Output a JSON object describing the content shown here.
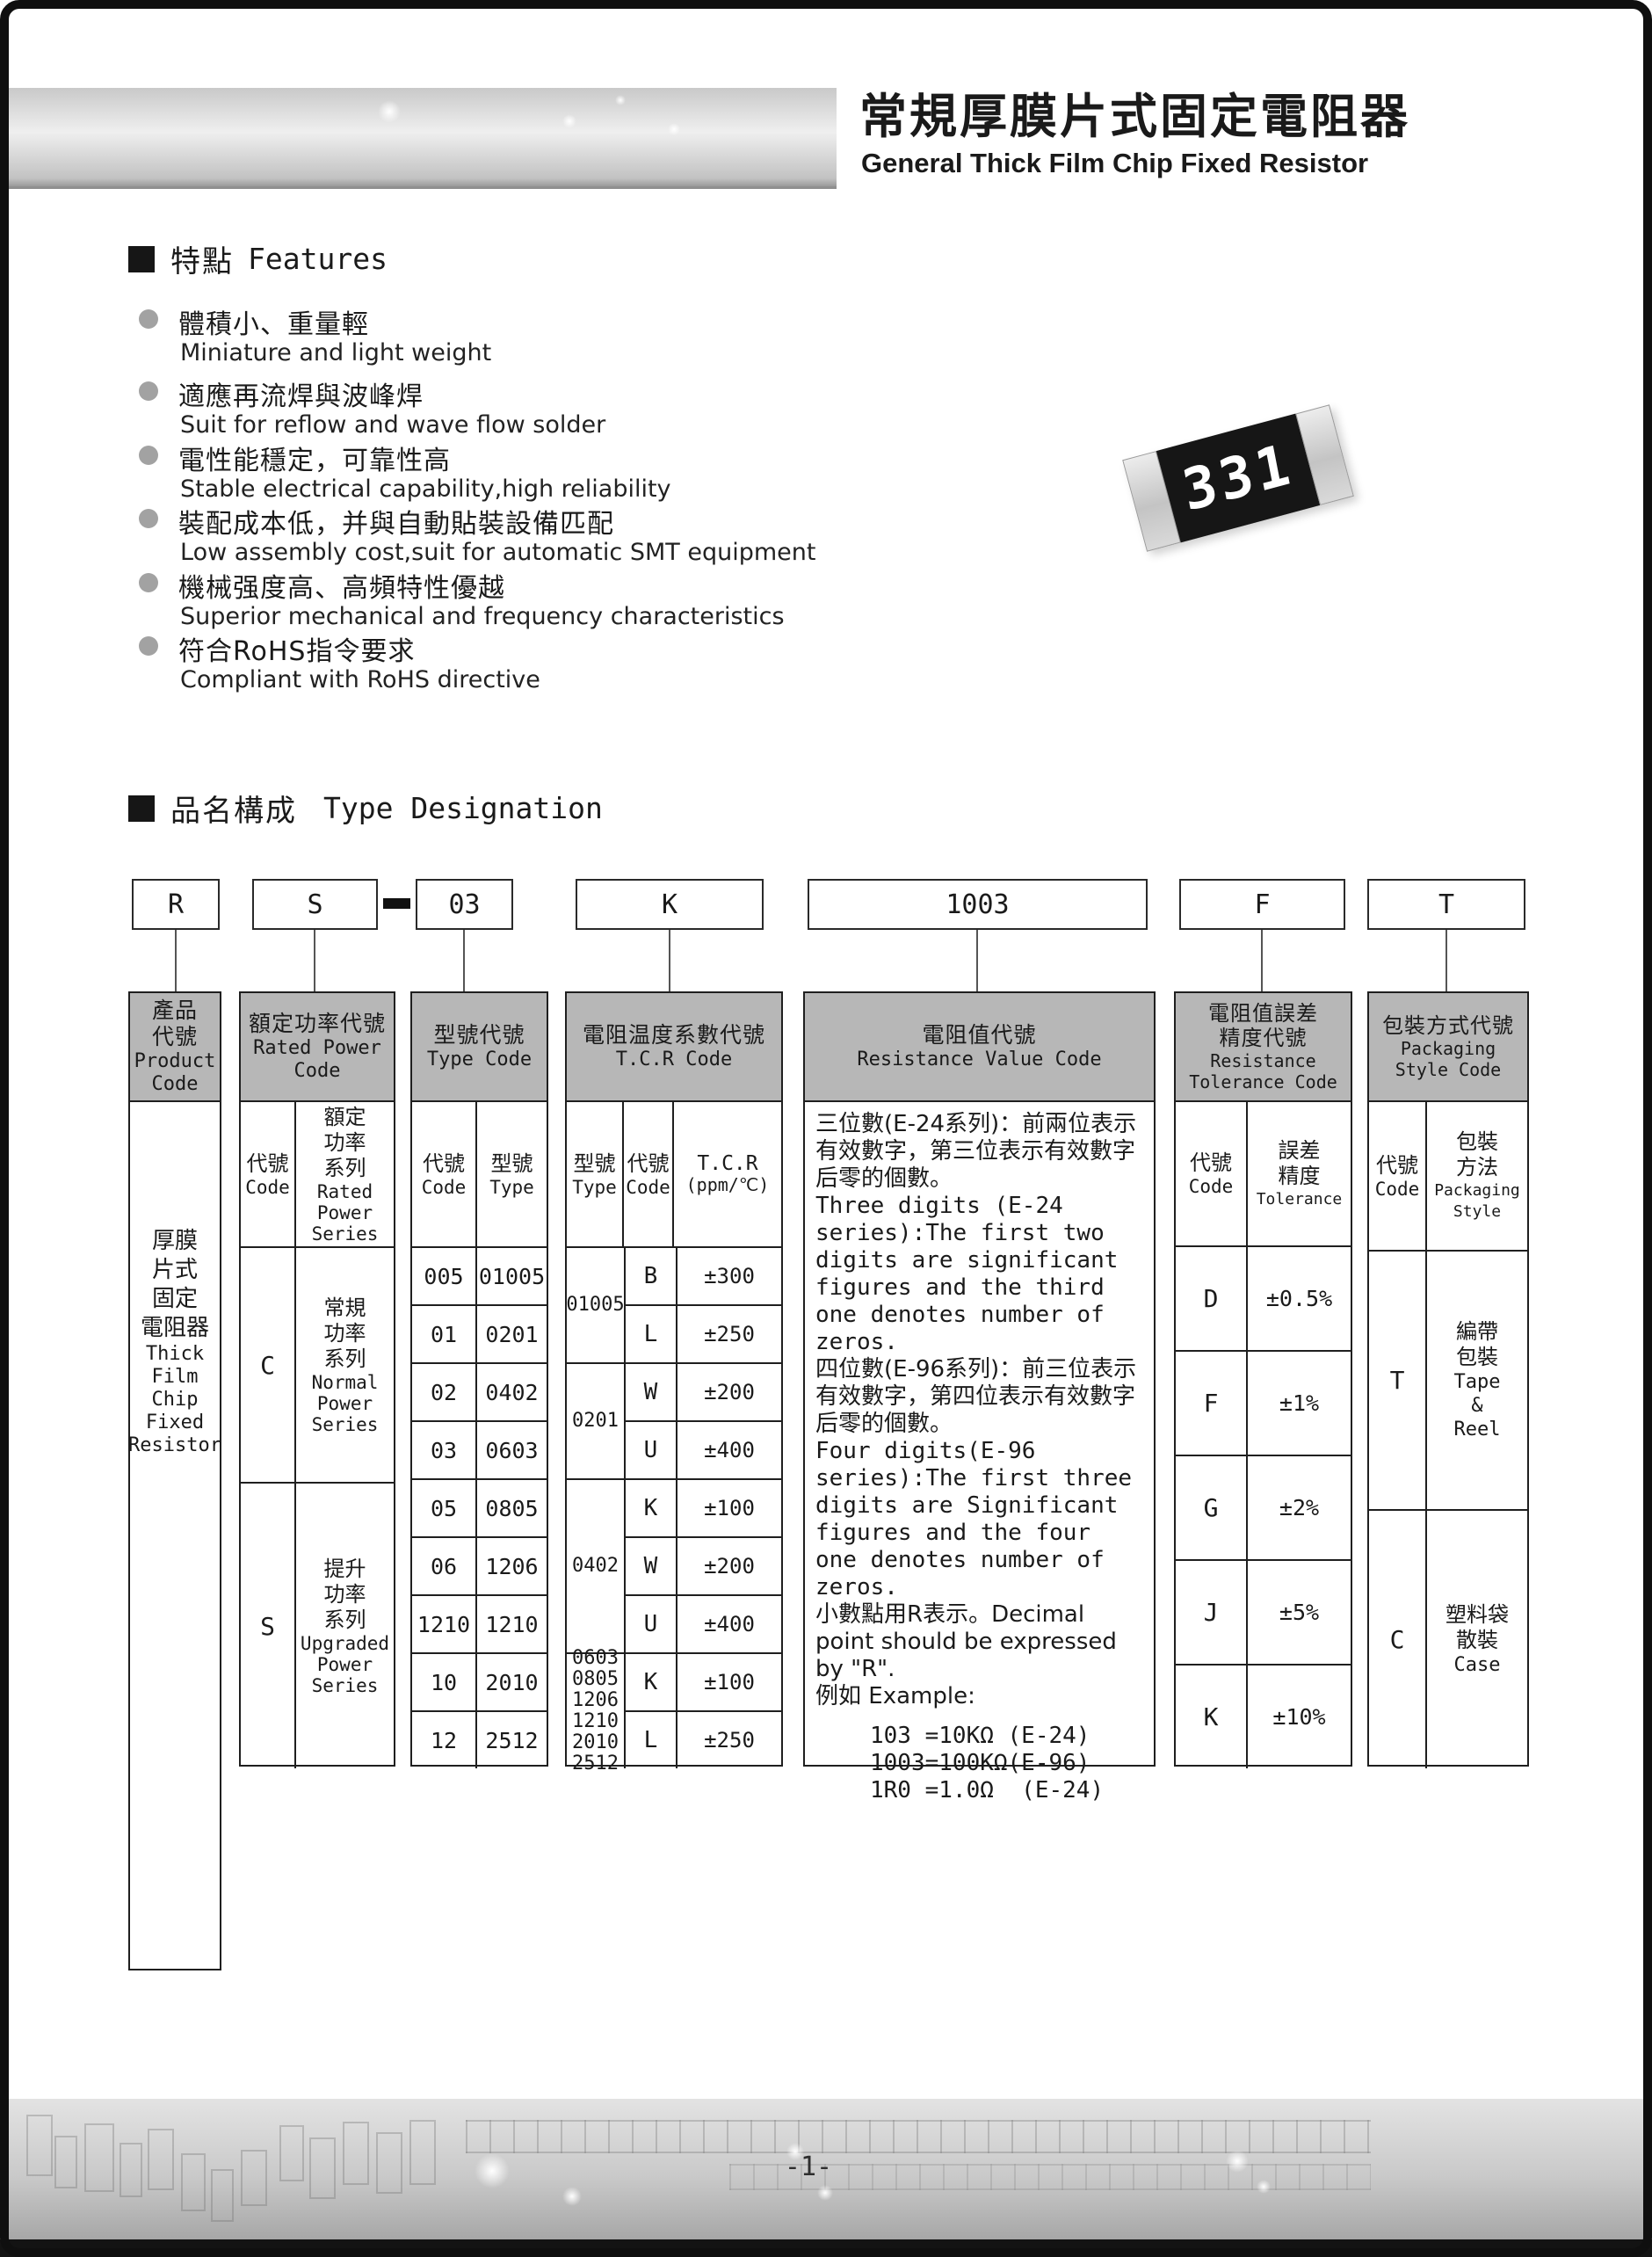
{
  "page": {
    "number": "-1-"
  },
  "header": {
    "title_cjk": "常規厚膜片式固定電阻器",
    "title_en": "General Thick Film Chip Fixed Resistor"
  },
  "features": {
    "heading_cjk": "特點",
    "heading_en": "Features",
    "items": [
      {
        "cjk": "體積小、重量輕",
        "en": "Miniature and light weight"
      },
      {
        "cjk": "適應再流焊與波峰焊",
        "en": "Suit for reflow and wave flow solder"
      },
      {
        "cjk": "電性能穩定，可靠性高",
        "en": "Stable electrical capability,high reliability"
      },
      {
        "cjk": "裝配成本低，并與自動貼裝設備匹配",
        "en": "Low assembly cost,suit for automatic SMT equipment"
      },
      {
        "cjk": "機械强度高、高頻特性優越",
        "en": "Superior mechanical and frequency characteristics"
      },
      {
        "cjk": "符合RoHS指令要求",
        "en": "Compliant with RoHS directive"
      }
    ]
  },
  "resistor": {
    "marking": "331"
  },
  "designation": {
    "heading_cjk": "品名構成",
    "heading_en": "Type Designation",
    "boxes": {
      "product": "R",
      "power": "S",
      "separator": "-",
      "type": "03",
      "tcr": "K",
      "value": "1003",
      "tolerance": "F",
      "packaging": "T"
    }
  },
  "table": {
    "product": {
      "header_cjk": [
        "產品",
        "代號"
      ],
      "header_en": [
        "Product",
        "Code"
      ],
      "body_cjk": [
        "厚膜",
        "片式",
        "固定",
        "電阻器"
      ],
      "body_en": [
        "Thick",
        "Film",
        "Chip",
        "Fixed",
        "Resistor"
      ]
    },
    "power": {
      "header_cjk": [
        "額定功率代號"
      ],
      "header_en": [
        "Rated Power",
        "Code"
      ],
      "code_label_cjk": "代號",
      "code_label_en": "Code",
      "series_label_cjk": [
        "額定",
        "功率",
        "系列"
      ],
      "series_label_en": [
        "Rated",
        "Power",
        "Series"
      ],
      "rows": [
        {
          "code": "C",
          "cjk": [
            "常規",
            "功率",
            "系列"
          ],
          "en": [
            "Normal",
            "Power",
            "Series"
          ]
        },
        {
          "code": "S",
          "cjk": [
            "提升",
            "功率",
            "系列"
          ],
          "en": [
            "Upgraded",
            "Power",
            "Series"
          ]
        }
      ]
    },
    "type": {
      "header_cjk": [
        "型號代號"
      ],
      "header_en": [
        "Type Code"
      ],
      "code_label_cjk": "代號",
      "code_label_en": "Code",
      "type_label_cjk": "型號",
      "type_label_en": "Type",
      "rows": [
        {
          "code": "005",
          "type": "01005"
        },
        {
          "code": "01",
          "type": "0201"
        },
        {
          "code": "02",
          "type": "0402"
        },
        {
          "code": "03",
          "type": "0603"
        },
        {
          "code": "05",
          "type": "0805"
        },
        {
          "code": "06",
          "type": "1206"
        },
        {
          "code": "1210",
          "type": "1210"
        },
        {
          "code": "10",
          "type": "2010"
        },
        {
          "code": "12",
          "type": "2512"
        }
      ]
    },
    "tcr": {
      "header_cjk": [
        "電阻温度系數代號"
      ],
      "header_en": [
        "T.C.R Code"
      ],
      "type_label_cjk": "型號",
      "type_label_en": "Type",
      "code_label_cjk": "代號",
      "code_label_en": "Code",
      "tcr_label": [
        "T.C.R",
        "(ppm/℃)"
      ],
      "groups": [
        {
          "types": [
            "01005"
          ],
          "rows": [
            {
              "code": "B",
              "tcr": "±300"
            },
            {
              "code": "L",
              "tcr": "±250"
            }
          ]
        },
        {
          "types": [
            "0201"
          ],
          "rows": [
            {
              "code": "W",
              "tcr": "±200"
            },
            {
              "code": "U",
              "tcr": "±400"
            }
          ]
        },
        {
          "types": [
            "0402"
          ],
          "rows": [
            {
              "code": "K",
              "tcr": "±100"
            },
            {
              "code": "W",
              "tcr": "±200"
            },
            {
              "code": "U",
              "tcr": "±400"
            }
          ]
        },
        {
          "types": [
            "0603",
            "0805",
            "1206",
            "1210",
            "2010",
            "2512"
          ],
          "rows": [
            {
              "code": "K",
              "tcr": "±100"
            },
            {
              "code": "L",
              "tcr": "±250"
            }
          ]
        }
      ]
    },
    "value": {
      "header_cjk": [
        "電阻值代號"
      ],
      "header_en": [
        "Resistance Value Code"
      ],
      "paragraphs": [
        "三位數(E-24系列)：前兩位表示有效數字，第三位表示有效數字后零的個數。",
        "Three digits (E-24 series):The first two digits are significant figures and the third one denotes number of zeros.",
        "四位數(E-96系列)：前三位表示有效數字，第四位表示有效數字后零的個數。",
        "Four digits(E-96 series):The first three digits are Significant figures and the four one denotes number of zeros.",
        "小數點用R表示。Decimal point should be expressed by \"R\".",
        "例如 Example:"
      ],
      "examples": [
        "103 =10KΩ (E-24)",
        "1003=100KΩ(E-96)",
        "1R0 =1.0Ω  (E-24)"
      ]
    },
    "tolerance": {
      "header_cjk": [
        "電阻值誤差",
        "精度代號"
      ],
      "header_en": [
        "Resistance",
        "Tolerance Code"
      ],
      "code_label_cjk": "代號",
      "code_label_en": "Code",
      "tol_label_cjk": [
        "誤差",
        "精度"
      ],
      "tol_label_en": [
        "Tolerance"
      ],
      "rows": [
        {
          "code": "D",
          "tol": "±0.5%"
        },
        {
          "code": "F",
          "tol": "±1%"
        },
        {
          "code": "G",
          "tol": "±2%"
        },
        {
          "code": "J",
          "tol": "±5%"
        },
        {
          "code": "K",
          "tol": "±10%"
        }
      ]
    },
    "packaging": {
      "header_cjk": [
        "包裝方式代號"
      ],
      "header_en": [
        "Packaging",
        "Style Code"
      ],
      "code_label_cjk": "代號",
      "code_label_en": "Code",
      "style_label_cjk": [
        "包裝",
        "方法"
      ],
      "style_label_en": [
        "Packaging",
        "Style"
      ],
      "rows": [
        {
          "code": "T",
          "cjk": [
            "編帶",
            "包裝"
          ],
          "en": [
            "Tape",
            "&",
            "Reel"
          ]
        },
        {
          "code": "C",
          "cjk": [
            "塑料袋",
            "散裝"
          ],
          "en": [
            "Case"
          ]
        }
      ]
    }
  },
  "colors": {
    "header_gray": "#b7b7b7",
    "band_light": "#efefef",
    "band_dark": "#9a9a9a",
    "frame_black": "#0f0f0f",
    "chip_body": "#161616",
    "chip_marking_text": "#ffffff"
  }
}
